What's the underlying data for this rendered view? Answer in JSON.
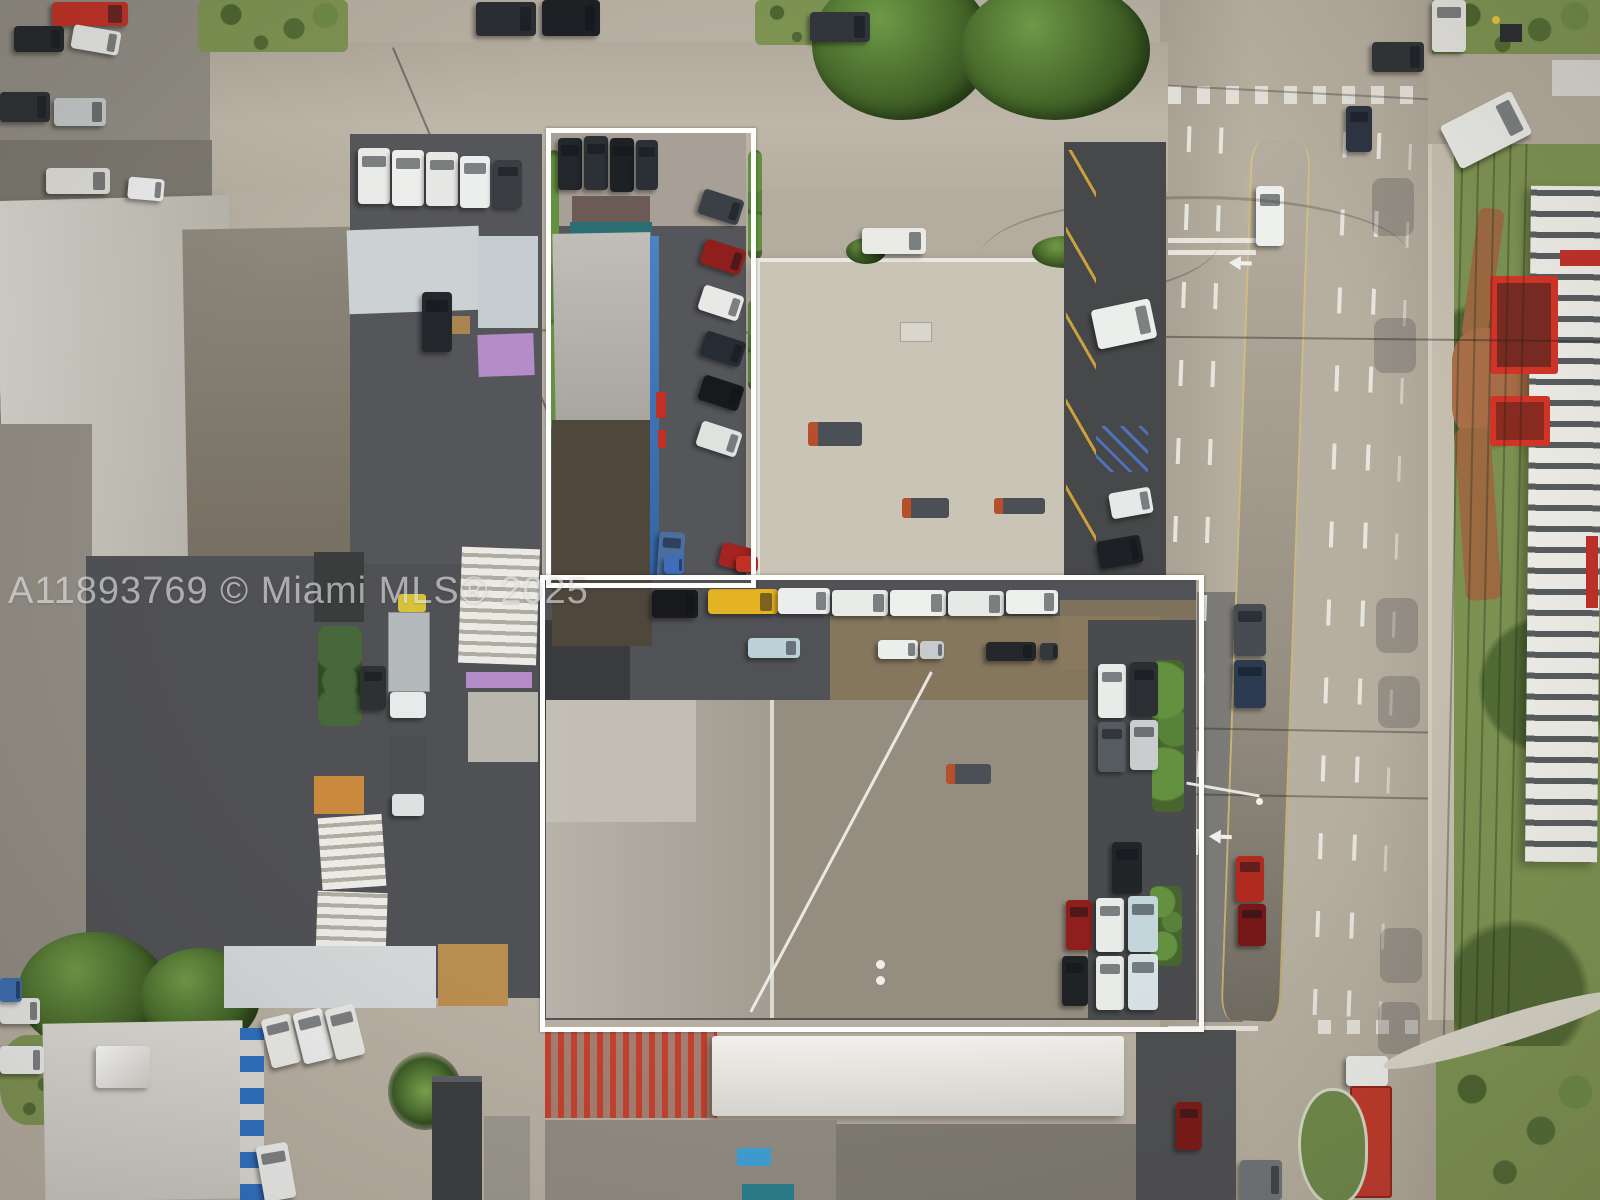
{
  "watermark": {
    "text": "A11893769 © Miami MLS® 2025"
  },
  "scene": {
    "description": "Aerial drone photo of a commercial industrial block; subject parcel highlighted with a white boundary outline; multi-lane divided highway on the right",
    "outline_color": "#ffffff"
  },
  "colors": {
    "concrete": "#b7afa2",
    "concrete_light": "#c2bbad",
    "highway": "#b3ab9c",
    "asphalt": "#505155",
    "asphalt_dark": "#47484a",
    "roof_white": "#d9d7d0",
    "roof_light": "#b8b3aa",
    "roof_mottled": "#cac4b6",
    "roof_dark_brown": "#4f463c",
    "roof_tan": "#958d7f",
    "dirt_tan": "#8a7a5e",
    "grass": "#7d9352",
    "hedge": "#49652f",
    "blue_stripe": "#2e6fc0",
    "teal_awning": "#2a6d72",
    "red_accent": "#d63427",
    "yellow_truck": "#e3b324",
    "lane_paint": "#f0efe9",
    "watermark_color": "#e6e6e6"
  }
}
